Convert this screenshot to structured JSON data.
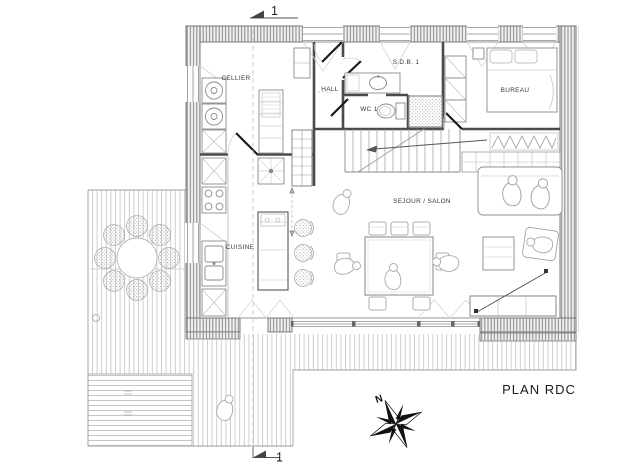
{
  "plan": {
    "title": "PLAN RDC",
    "rooms": {
      "cellier": "CELLIER",
      "hall": "HALL",
      "sdb1": "S.D.B. 1",
      "wc1": "WC 1",
      "bureau": "BUREAU",
      "cuisine": "CUISINE",
      "sejour_salon": "SEJOUR / SALON"
    },
    "section_marker_top": "1",
    "section_marker_bottom": "1",
    "compass_north": "N",
    "colors": {
      "background": "#ffffff",
      "wall_outline": "#6e6e6e",
      "wall_hatch": "#8f8f8f",
      "deck_line": "#c3c3c3",
      "partition": "#4a4a4a",
      "fixture_line": "#8a8a8a",
      "door_leaf": "#1a1a1a",
      "label_text": "#3a3a3a",
      "title_text": "#1b1b1b"
    }
  }
}
